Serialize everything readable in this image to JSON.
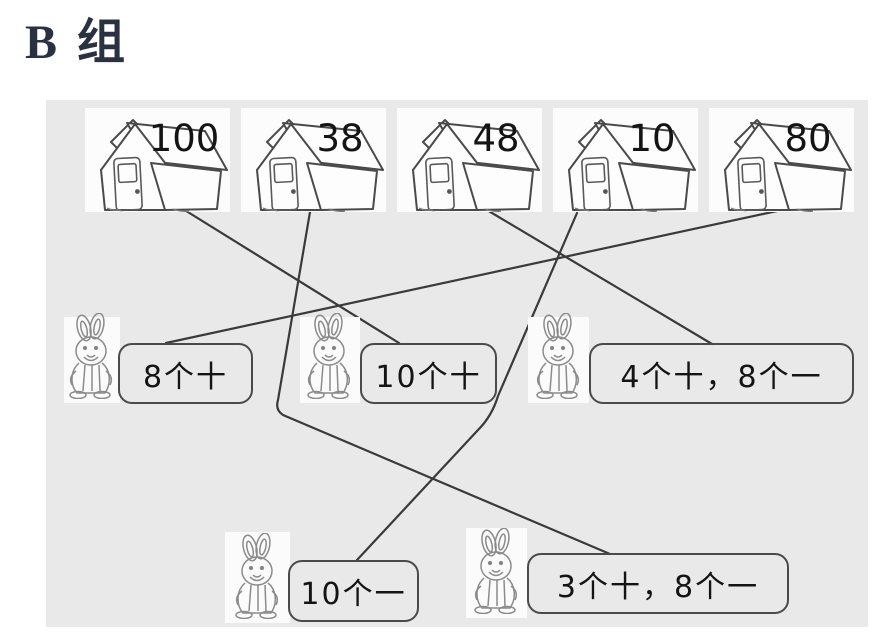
{
  "title": "B 组",
  "exercise": {
    "houses": [
      {
        "number": "100"
      },
      {
        "number": "38"
      },
      {
        "number": "48"
      },
      {
        "number": "10"
      },
      {
        "number": "80"
      }
    ],
    "labels_middle": [
      {
        "text": "8个十"
      },
      {
        "text": "10个十"
      },
      {
        "text": "4个十，8个一"
      }
    ],
    "labels_bottom": [
      {
        "text": "10个一"
      },
      {
        "text": "3个十，8个一"
      }
    ],
    "connections": [
      {
        "from": "100",
        "to": "10个十"
      },
      {
        "from": "38",
        "to": "3个十，8个一"
      },
      {
        "from": "48",
        "to": "4个十，8个一"
      },
      {
        "from": "10",
        "to": "10个一"
      },
      {
        "from": "80",
        "to": "8个十"
      }
    ]
  },
  "colors": {
    "page_bg": "#ffffff",
    "panel_bg": "#e9e9e9",
    "tile_bg": "#fcfcfc",
    "line": "#3a3a3a",
    "text": "#141414",
    "title": "#2a3140"
  }
}
